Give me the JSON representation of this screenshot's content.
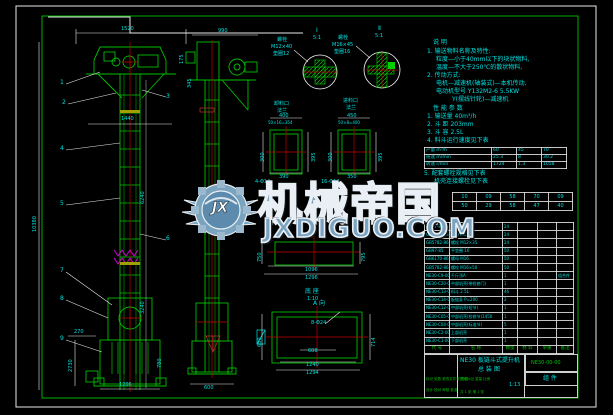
{
  "meta": {
    "sheet_bg": "#000000",
    "line_green": "#00c000",
    "accent_cyan": "#00e0e0",
    "accent_red": "#c00000",
    "accent_magenta": "#e000e0",
    "accent_yellow": "#b0b000",
    "watermark_blue": "#7aa3c0"
  },
  "watermark": {
    "initials": "JX",
    "brand": "机械帝国",
    "site": "JXDIGUO.COM"
  },
  "title_block": {
    "product": "NE30 板链斗式提升机",
    "doc_type": "总 装 图",
    "drawing_no": "NE30-00-00",
    "part_class": "组 件",
    "rev_header": "标记 处数 更改文件号 签名",
    "sign_row": "设计  校对  审核  批准",
    "stage_row": "阶段标记  重量  比例",
    "scale": "1:13",
    "sheet_count": "共 1 张  第 1 张"
  },
  "tables": {
    "performance": {
      "rows": [
        [
          "产量 m³/h",
          "60",
          "45",
          "70"
        ],
        [
          "链速 m/min",
          "25.3",
          "8",
          "30.2"
        ],
        [
          "转速 r/min",
          "1724",
          "1.3",
          "1058"
        ]
      ]
    },
    "sprocket": {
      "rows": [
        [
          "10",
          "09",
          "58",
          "70",
          "09"
        ],
        [
          "50",
          "29",
          "58",
          "47",
          "40"
        ]
      ]
    },
    "bom": {
      "header": [
        "代 号",
        "名 称",
        "数量",
        "材 料",
        "单重",
        "备注"
      ],
      "rows": [
        [
          "GB97-85",
          "垫圈 12",
          "24",
          "",
          "",
          ""
        ],
        [
          "GB6170-86",
          "螺母 M12",
          "24",
          "",
          "",
          ""
        ],
        [
          "GB5782-86",
          "螺栓 M12×35",
          "24",
          "",
          "",
          ""
        ],
        [
          "GB97-85",
          "平垫圈 16",
          "50",
          "",
          "",
          ""
        ],
        [
          "GB6170-86",
          "螺母 M16",
          "50",
          "",
          "",
          ""
        ],
        [
          "GB5782-86",
          "螺栓 M16×50",
          "50",
          "",
          "",
          ""
        ],
        [
          "NE30-C9-00",
          "千斤顶A",
          "1",
          "",
          "",
          "组合件"
        ],
        [
          "NE30-C20-00",
          "中部机壳(带检修门)",
          "1",
          "",
          "",
          ""
        ],
        [
          "NE30-C13-00",
          "料斗 2.5L",
          "46",
          "",
          "",
          ""
        ],
        [
          "NE30-C14-00",
          "板链条 P=200",
          "2",
          "",
          "",
          ""
        ],
        [
          "NE30-C12-00",
          "中部机壳(短节)",
          "1",
          "",
          "",
          ""
        ],
        [
          "NE30-C05-00",
          "中部机壳(检修节)1450",
          "1",
          "",
          "",
          ""
        ],
        [
          "NE30-C04-00",
          "中部机壳(标准节)",
          "5",
          "",
          "",
          ""
        ],
        [
          "NE30-C2-00",
          "上部机壳",
          "1",
          "",
          "",
          ""
        ],
        [
          "NE30-C1-00",
          "下部机壳",
          "1",
          "",
          "",
          ""
        ]
      ]
    }
  },
  "annotations": {
    "labels": [
      {
        "t": "说 明",
        "x": 433,
        "y": 40,
        "k": "c6"
      },
      {
        "t": "1. 输送物料名称及特性:",
        "x": 427,
        "y": 49,
        "k": "c6"
      },
      {
        "t": "粒度—小于40mm以下的块状物料,",
        "x": 436,
        "y": 57,
        "k": "c6"
      },
      {
        "t": "温度—不大于250℃的散状物料,",
        "x": 436,
        "y": 65,
        "k": "c6"
      },
      {
        "t": "2. 传动方式:",
        "x": 427,
        "y": 73,
        "k": "c6"
      },
      {
        "t": "电机—减速机(轴装式)—本机传动,",
        "x": 436,
        "y": 81,
        "k": "c6"
      },
      {
        "t": "电动机型号 Y132M2-6  5.5KW",
        "x": 436,
        "y": 89,
        "k": "c6"
      },
      {
        "t": "Y(摆线针轮)—减速机",
        "x": 452,
        "y": 97,
        "k": "c6"
      },
      {
        "t": "性 能 参 数",
        "x": 433,
        "y": 106,
        "k": "c6"
      },
      {
        "t": "1. 输送量 40m³/h",
        "x": 427,
        "y": 114,
        "k": "c6"
      },
      {
        "t": "2. 斗 距 203mm",
        "x": 427,
        "y": 122,
        "k": "c6"
      },
      {
        "t": "3. 斗 容 2.5L",
        "x": 427,
        "y": 130,
        "k": "c6"
      },
      {
        "t": "4. 料斗运行速度见下表",
        "x": 427,
        "y": 138,
        "k": "c6"
      },
      {
        "t": "5. 配套螺栓规格见下表",
        "x": 424,
        "y": 171,
        "k": "c6"
      },
      {
        "t": "机壳连接螺栓见下表",
        "x": 434,
        "y": 179,
        "k": "c6"
      },
      {
        "t": "1520",
        "x": 121,
        "y": 27
      },
      {
        "t": "1440",
        "x": 121,
        "y": 117
      },
      {
        "t": "175",
        "x": 180,
        "y": 64,
        "r": 1
      },
      {
        "t": "345",
        "x": 188,
        "y": 88,
        "r": 1
      },
      {
        "t": "10380",
        "x": 33,
        "y": 232,
        "r": 1
      },
      {
        "t": "6240",
        "x": 141,
        "y": 204,
        "r": 1
      },
      {
        "t": "3240",
        "x": 141,
        "y": 314,
        "r": 1
      },
      {
        "t": "780",
        "x": 158,
        "y": 368,
        "r": 1
      },
      {
        "t": "270",
        "x": 74,
        "y": 330
      },
      {
        "t": "2730",
        "x": 69,
        "y": 372,
        "r": 1
      },
      {
        "t": "1206",
        "x": 119,
        "y": 383
      },
      {
        "t": "990",
        "x": 218,
        "y": 29
      },
      {
        "t": "600",
        "x": 204,
        "y": 386
      },
      {
        "t": "400",
        "x": 279,
        "y": 114
      },
      {
        "t": "50×16=354",
        "x": 268,
        "y": 121,
        "k": "c4"
      },
      {
        "t": "390",
        "x": 279,
        "y": 175
      },
      {
        "t": "300",
        "x": 261,
        "y": 162,
        "r": 1
      },
      {
        "t": "395",
        "x": 312,
        "y": 162,
        "r": 1
      },
      {
        "t": "4-Φ14",
        "x": 255,
        "y": 180
      },
      {
        "t": "450",
        "x": 347,
        "y": 114
      },
      {
        "t": "50×8=400",
        "x": 338,
        "y": 121,
        "k": "c4"
      },
      {
        "t": "350",
        "x": 347,
        "y": 175
      },
      {
        "t": "300",
        "x": 329,
        "y": 162,
        "r": 1
      },
      {
        "t": "395",
        "x": 379,
        "y": 162,
        "r": 1
      },
      {
        "t": "16-Φ14",
        "x": 321,
        "y": 180
      },
      {
        "t": "1096",
        "x": 305,
        "y": 268
      },
      {
        "t": "1296",
        "x": 305,
        "y": 276
      },
      {
        "t": "750",
        "x": 258,
        "y": 262,
        "r": 1
      },
      {
        "t": "795",
        "x": 362,
        "y": 262,
        "r": 1
      },
      {
        "t": "底 座",
        "x": 305,
        "y": 289,
        "k": "c6"
      },
      {
        "t": "1:10",
        "x": 307,
        "y": 297
      },
      {
        "t": "A 向",
        "x": 313,
        "y": 301,
        "k": "c6"
      },
      {
        "t": "8-Φ24",
        "x": 311,
        "y": 321
      },
      {
        "t": "608",
        "x": 308,
        "y": 349
      },
      {
        "t": "1240",
        "x": 306,
        "y": 363
      },
      {
        "t": "1294",
        "x": 306,
        "y": 371
      },
      {
        "t": "650",
        "x": 258,
        "y": 347,
        "r": 1
      },
      {
        "t": "714",
        "x": 372,
        "y": 347,
        "r": 1
      },
      {
        "t": "Ⅰ",
        "x": 316,
        "y": 28,
        "k": "c6"
      },
      {
        "t": "5:1",
        "x": 313,
        "y": 36
      },
      {
        "t": "Ⅱ",
        "x": 378,
        "y": 26,
        "k": "c6"
      },
      {
        "t": "5:1",
        "x": 375,
        "y": 34
      },
      {
        "t": "螺栓",
        "x": 277,
        "y": 38
      },
      {
        "t": "M12×40",
        "x": 271,
        "y": 45
      },
      {
        "t": "垫圈12",
        "x": 273,
        "y": 52
      },
      {
        "t": "螺栓",
        "x": 338,
        "y": 36
      },
      {
        "t": "M16×45",
        "x": 332,
        "y": 43
      },
      {
        "t": "垫圈16",
        "x": 334,
        "y": 50
      },
      {
        "t": "卸料口",
        "x": 274,
        "y": 102
      },
      {
        "t": "法兰",
        "x": 277,
        "y": 109
      },
      {
        "t": "进料口",
        "x": 343,
        "y": 99
      },
      {
        "t": "法兰",
        "x": 346,
        "y": 106
      }
    ],
    "balloons": [
      {
        "t": "1",
        "x": 60,
        "y": 80
      },
      {
        "t": "2",
        "x": 62,
        "y": 100
      },
      {
        "t": "3",
        "x": 166,
        "y": 94
      },
      {
        "t": "4",
        "x": 60,
        "y": 146
      },
      {
        "t": "5",
        "x": 60,
        "y": 201
      },
      {
        "t": "6",
        "x": 166,
        "y": 236
      },
      {
        "t": "7",
        "x": 60,
        "y": 268
      },
      {
        "t": "8",
        "x": 60,
        "y": 296
      },
      {
        "t": "9",
        "x": 60,
        "y": 336
      }
    ]
  }
}
